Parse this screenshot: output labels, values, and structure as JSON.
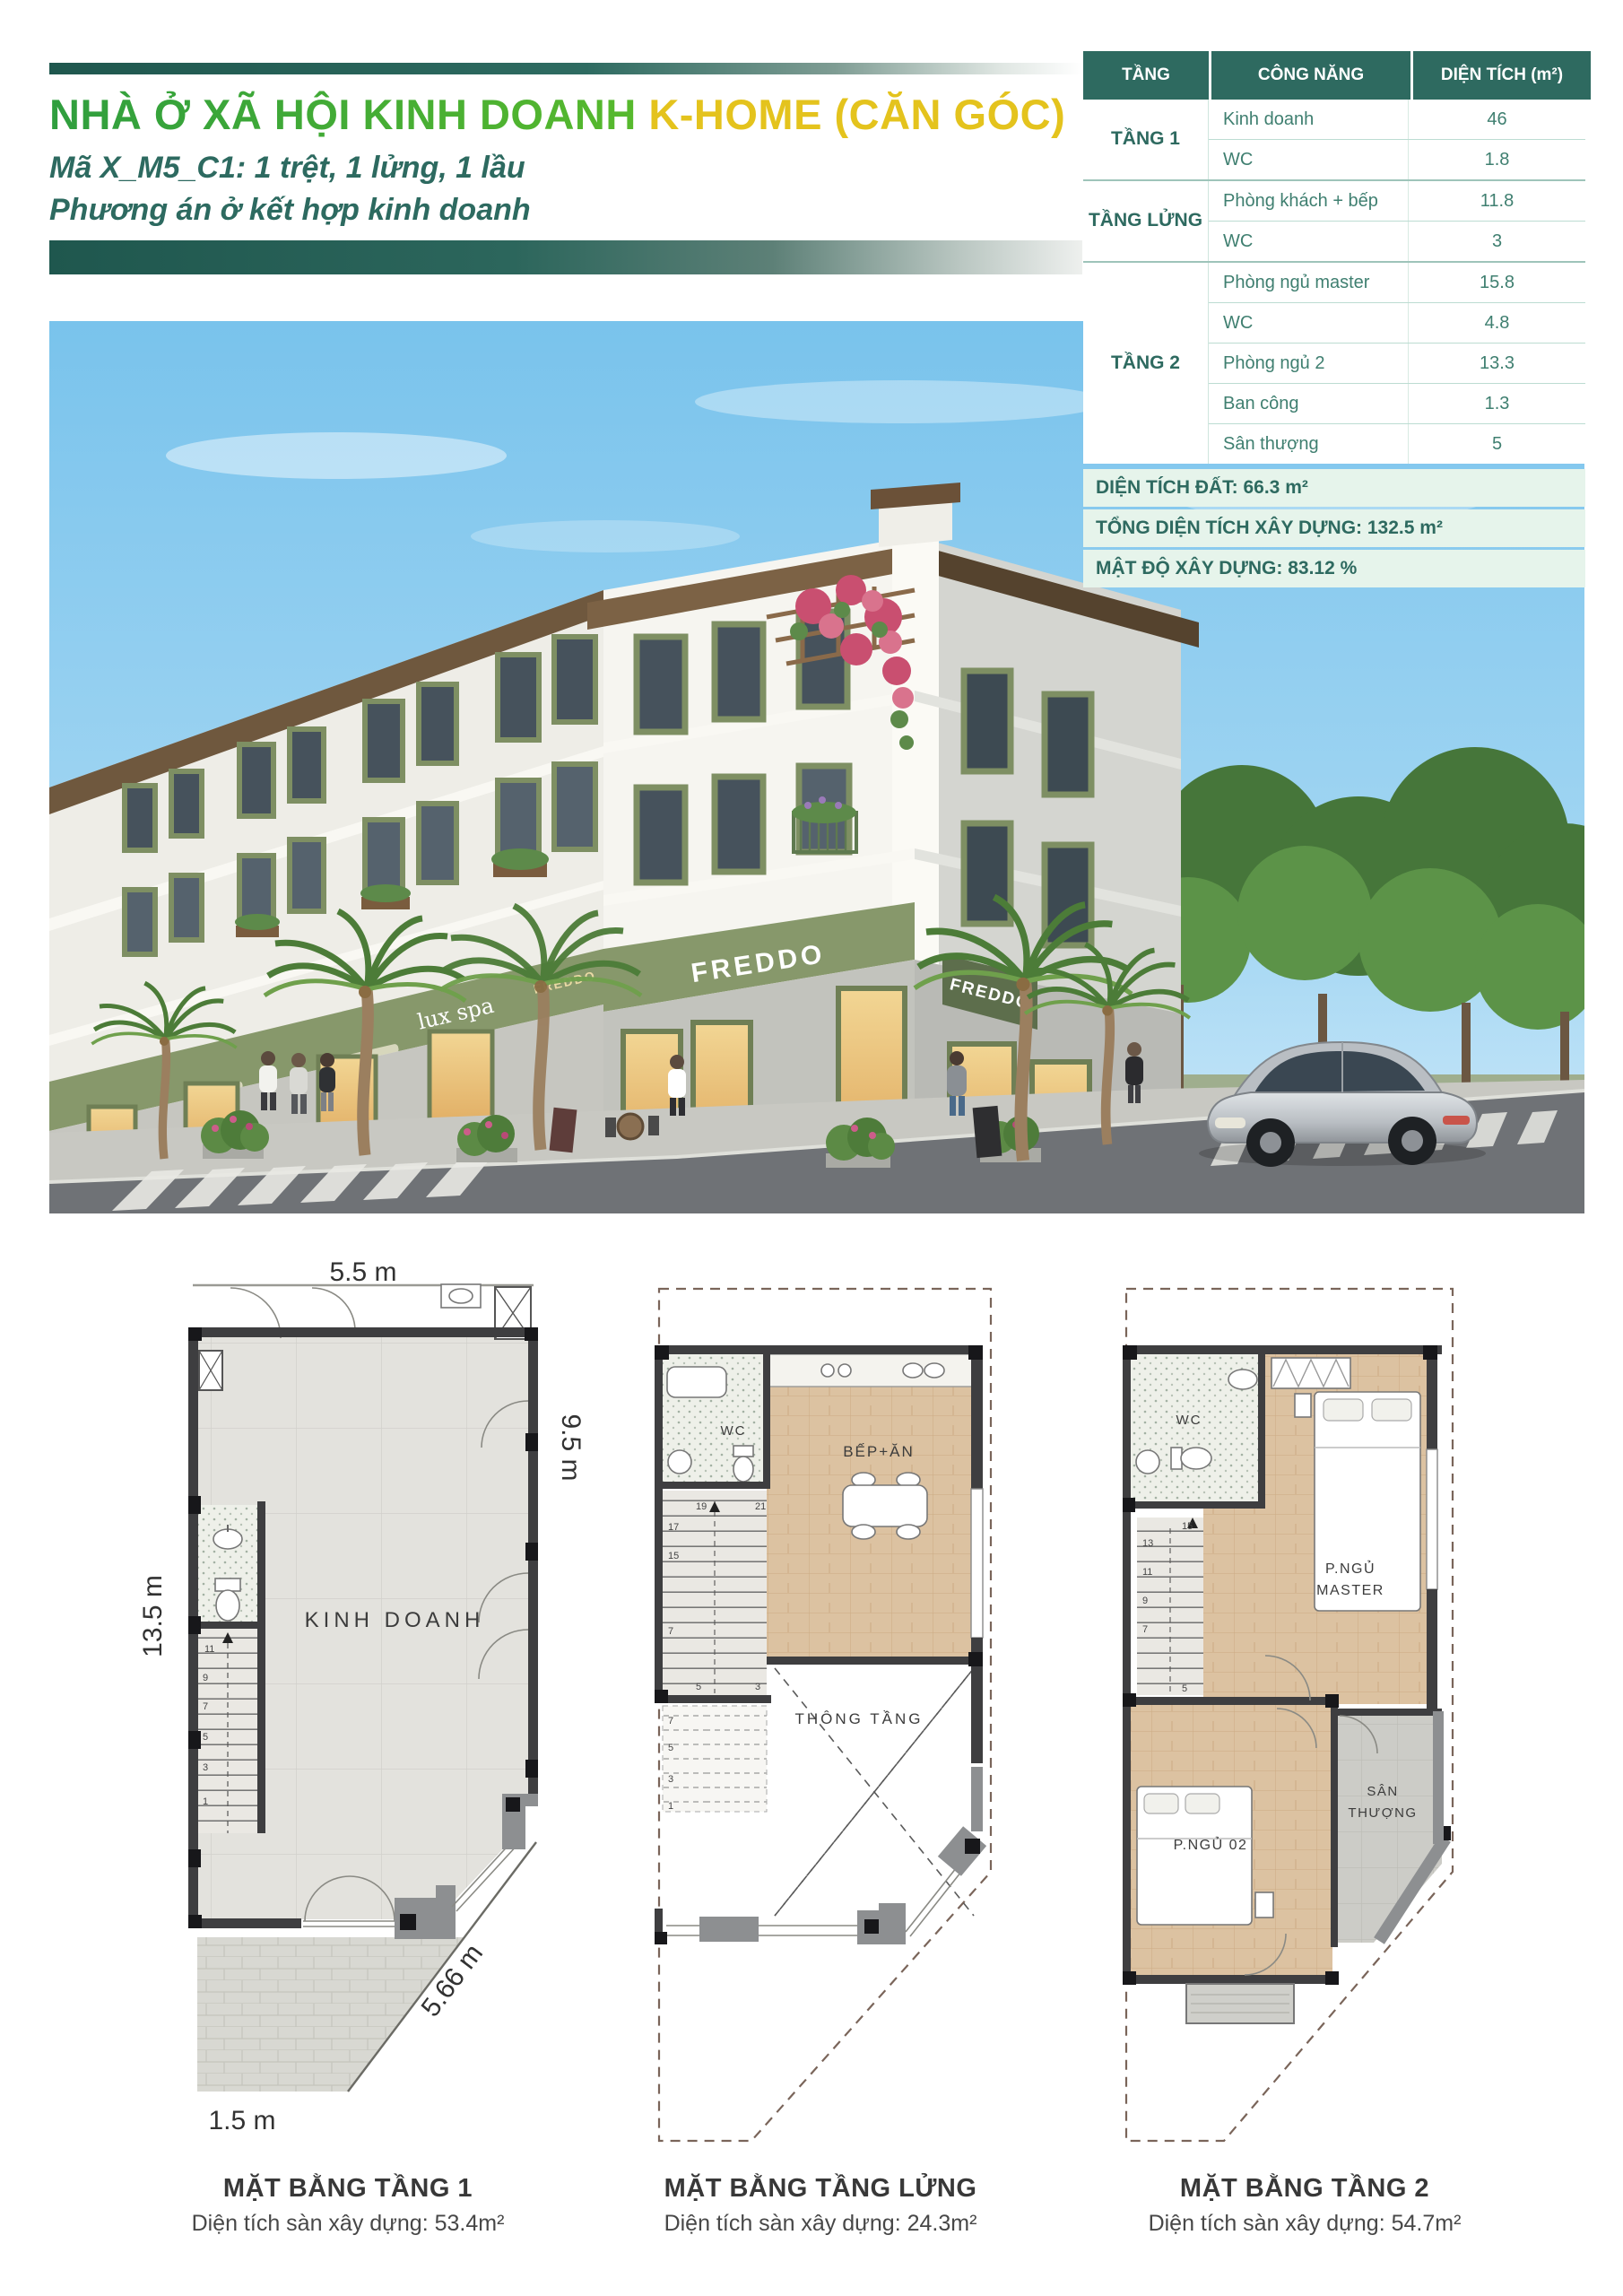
{
  "header": {
    "title_main": "NHÀ Ở XÃ HỘI KINH DOANH",
    "title_suffix": "K-HOME (CĂN GÓC)",
    "subtitle_line1": "Mã X_M5_C1: 1 trệt, 1 lửng, 1 lầu",
    "subtitle_line2": "Phương án ở kết hợp kinh doanh",
    "accent_green": "#3aa339",
    "accent_yellow": "#e4c31d",
    "accent_teal": "#2d6a60"
  },
  "area_table": {
    "col_floor": "TẦNG",
    "col_function": "CÔNG NĂNG",
    "col_area": "DIỆN TÍCH (m²)",
    "groups": [
      {
        "floor": "TẦNG 1",
        "rows": [
          {
            "name": "Kinh doanh",
            "area": "46"
          },
          {
            "name": "WC",
            "area": "1.8"
          }
        ]
      },
      {
        "floor": "TẦNG LỬNG",
        "rows": [
          {
            "name": "Phòng khách + bếp",
            "area": "11.8"
          },
          {
            "name": "WC",
            "area": "3"
          }
        ]
      },
      {
        "floor": "TẦNG 2",
        "rows": [
          {
            "name": "Phòng ngủ master",
            "area": "15.8"
          },
          {
            "name": "WC",
            "area": "4.8"
          },
          {
            "name": "Phòng ngủ 2",
            "area": "13.3"
          },
          {
            "name": "Ban công",
            "area": "1.3"
          },
          {
            "name": "Sân thượng",
            "area": "5"
          }
        ]
      }
    ]
  },
  "summary": {
    "land_area": "DIỆN TÍCH ĐẤT: 66.3 m²",
    "total_floor_area": "TỔNG DIỆN TÍCH XÂY DỰNG: 132.5 m²",
    "density": "MẬT ĐỘ XÂY DỰNG: 83.12 %"
  },
  "photo": {
    "signs": {
      "freddo": "FREDDO",
      "lux_spa": "lux spa"
    }
  },
  "floor_plans": [
    {
      "caption": "MẶT BẰNG TẦNG 1",
      "note": "Diện tích sàn xây dựng: 53.4m²",
      "room": "KINH DOANH",
      "dims": {
        "top": "5.5 m",
        "left": "13.5 m",
        "right": "9.5 m",
        "bottom": "1.5 m",
        "diagonal": "5.66 m"
      },
      "stairs": [
        "11",
        "9",
        "7",
        "5",
        "3",
        "1"
      ]
    },
    {
      "caption": "MẶT BẰNG TẦNG LỬNG",
      "note": "Diện tích sàn xây dựng: 24.3m²",
      "wc": "WC",
      "kitchen": "BẾP+ĂN",
      "void": "THÔNG TẦNG",
      "stairs_upper": [
        "21",
        "19",
        "17",
        "15",
        "7",
        "5",
        "3"
      ],
      "stairs_ghost": [
        "7",
        "5",
        "3",
        "1"
      ]
    },
    {
      "caption": "MẶT BẰNG TẦNG 2",
      "note": "Diện tích sàn xây dựng: 54.7m²",
      "wc": "WC",
      "master_l1": "P.NGỦ",
      "master_l2": "MASTER",
      "bedroom2": "P.NGỦ 02",
      "terrace_l1": "SÂN",
      "terrace_l2": "THƯỢNG",
      "stairs": [
        "15",
        "13",
        "11",
        "9",
        "7",
        "5"
      ]
    }
  ]
}
